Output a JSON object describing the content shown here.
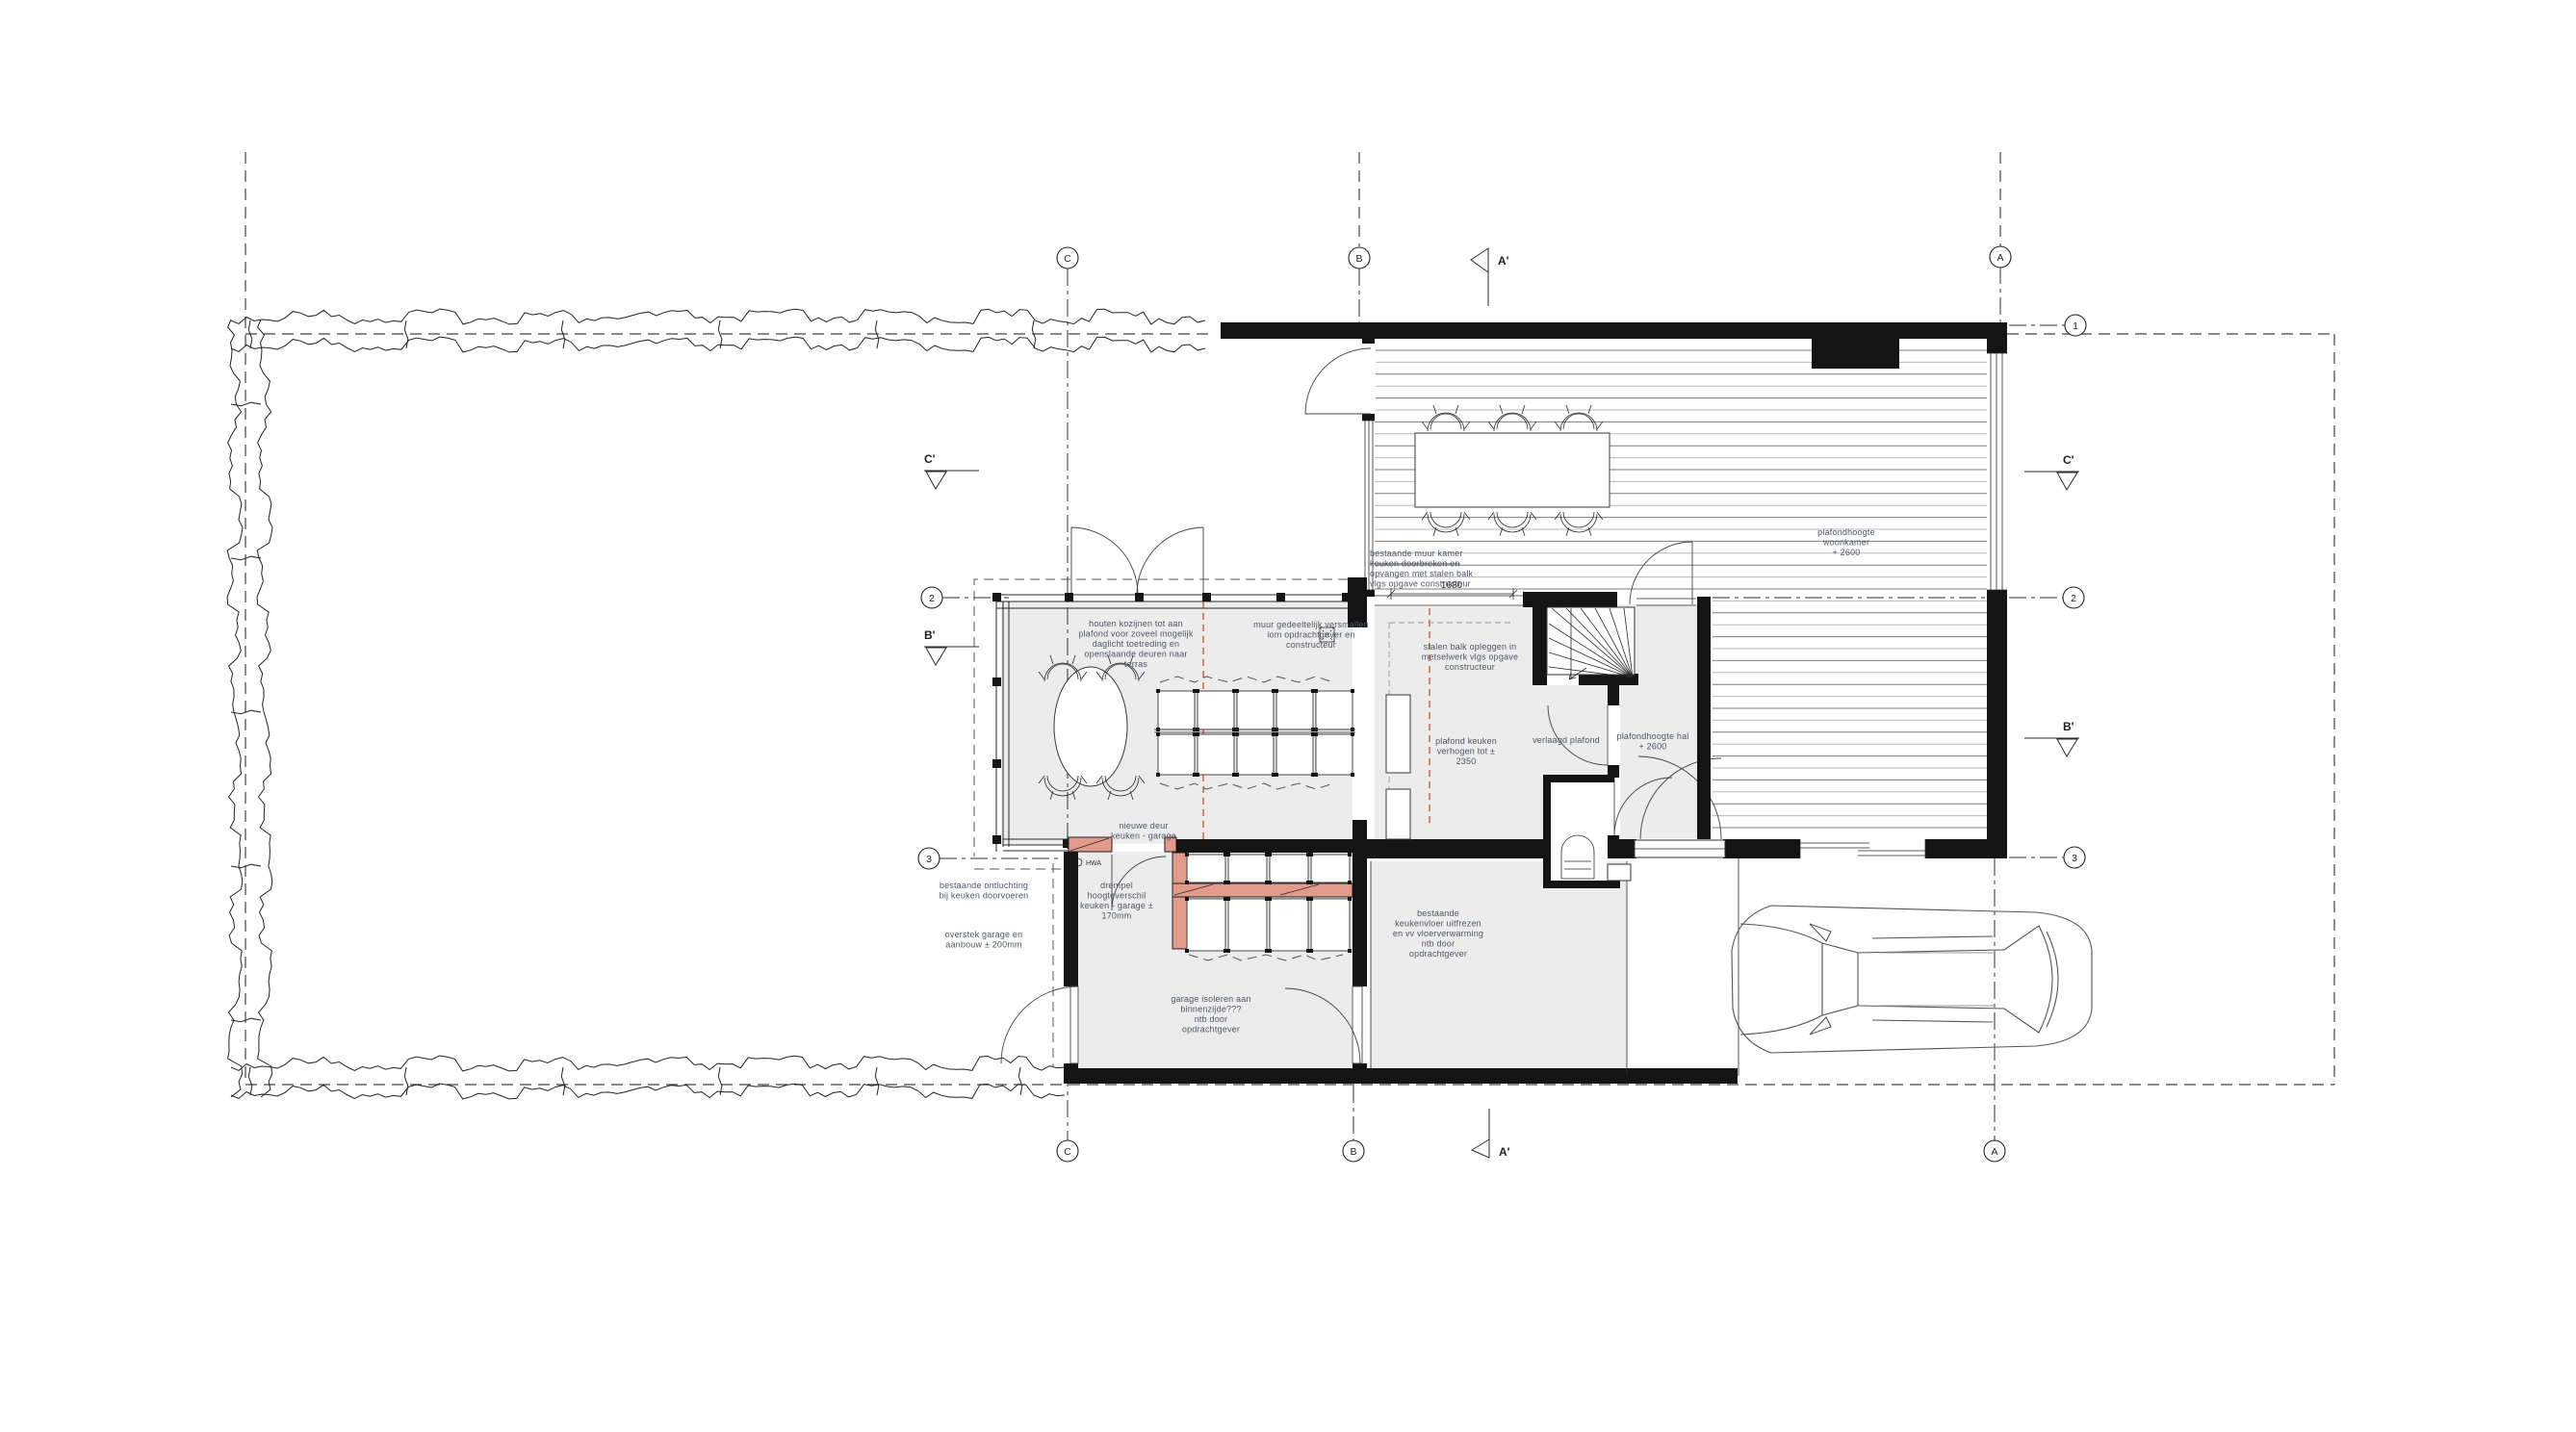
{
  "drawing": {
    "grid_markers": {
      "c": "C",
      "b": "B",
      "a": "A",
      "n1": "1",
      "n2": "2",
      "n3": "3"
    },
    "section_markers": {
      "a": "A'",
      "b": "B'",
      "c": "C'"
    },
    "dimensions": {
      "kitchen_opening": "1680"
    },
    "symbols": {
      "rainwater_downpipe": "HWA"
    },
    "colors": {
      "wall": "#141414",
      "new_wall_fill": "#e29a8b",
      "demolition_line": "#cf3b2a",
      "room_fill": "#ececec",
      "annotation_text": "#4d5663"
    },
    "annotations": {
      "bestaande_muur": {
        "lines": [
          "bestaande muur kamer",
          "keuken doorbreken en",
          "opvangen met stalen balk",
          "vlgs opgave constructeur"
        ]
      },
      "plafondhoogte_woonkamer": {
        "lines": [
          "plafondhoogte",
          "woonkamer",
          "+ 2600"
        ]
      },
      "houten_kozijnen": {
        "lines": [
          "houten kozijnen tot aan",
          "plafond voor zoveel mogelijk",
          "daglicht toetreding en",
          "openslaande deuren naar",
          "terras"
        ]
      },
      "muur_versmallen": {
        "lines": [
          "muur gedeeltelijk versmallen",
          "iom opdrachtgever en",
          "constructeur"
        ]
      },
      "stalen_balk": {
        "lines": [
          "stalen balk opleggen in",
          "metselwerk vlgs opgave",
          "constructeur"
        ]
      },
      "plafond_keuken": {
        "lines": [
          "plafond keuken",
          "verhogen tot ±",
          "2350"
        ]
      },
      "verlaagd_plafond": {
        "lines": [
          "verlaagd plafond"
        ]
      },
      "plafondhoogte_hal": {
        "lines": [
          "plafondhoogte hal",
          "+ 2600"
        ]
      },
      "nieuwe_deur": {
        "lines": [
          "nieuwe deur",
          "keuken - garage"
        ]
      },
      "drempel": {
        "lines": [
          "drempel",
          "hoogteverschil",
          "keuken - garage ±",
          "170mm"
        ]
      },
      "ontluchting": {
        "lines": [
          "bestaande ontluchting",
          "bij keuken doorvoeren"
        ]
      },
      "overstek": {
        "lines": [
          "overstek garage en",
          "aanbouw ± 200mm"
        ]
      },
      "garage_isoleren": {
        "lines": [
          "garage isoleren aan",
          "binnenzijde???",
          "ntb door",
          "opdrachtgever"
        ]
      },
      "keukenvloer": {
        "lines": [
          "bestaande",
          "keukenvloer uitfrezen",
          "en vv vloerverwarming",
          "ntb door",
          "opdrachtgever"
        ]
      }
    }
  }
}
